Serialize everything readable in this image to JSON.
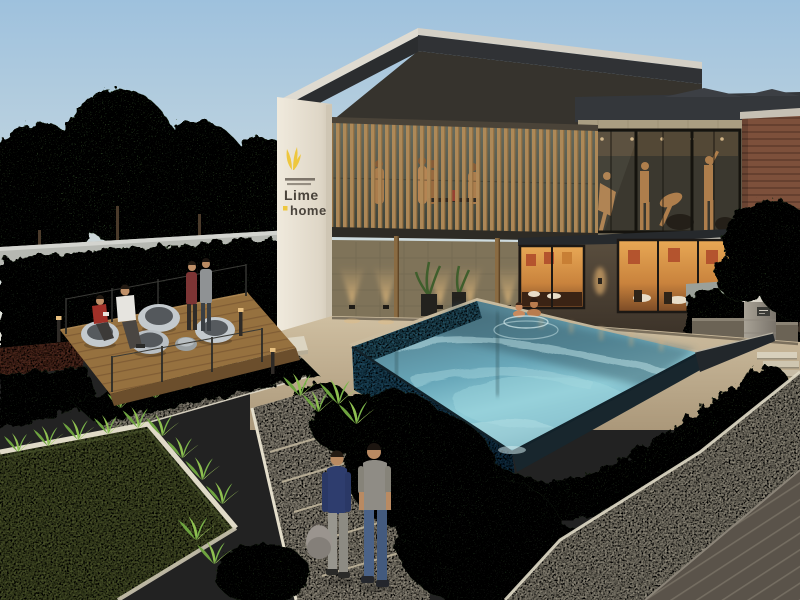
{
  "scene": {
    "title": "Residential clubhouse with infinity pool at dusk — architectural rendering",
    "signage": {
      "line1": "Lime",
      "line2": "home",
      "tagline_rows": 2
    },
    "people": {
      "lounge_deck_people": 4,
      "pool_swimmers": 2,
      "gym_silhouettes": 4,
      "foreground_walkers": 2
    }
  },
  "palette": {
    "sky_top": "#9ec1dd",
    "sky_horizon": "#e3e3d8",
    "roof_fascia_light": "#dfdbd1",
    "roof_dark": "#2b2d2f",
    "slat_wood": "#b08a58",
    "signage_wall_white": "#ece7db",
    "sign_yellow": "#eec73e",
    "sign_text": "#4a443c",
    "gym_frame_tan": "#aa9e82",
    "brick": "#7d503b",
    "interior_glow": "#e8a855",
    "uplight_glow": "#e7bd7e",
    "water_bright": "#8ecbd6",
    "water_deep": "#517d8c",
    "mosaic_tile": "#2f6e8a",
    "hedge_dark": "#2a4222",
    "spiky_plant": "#7fb24a",
    "lawn": "#6e7a41",
    "path_stone": "#d6ccb6",
    "deck_wood": "#96713f",
    "board_deck": "#59524a",
    "chair_shell": "#c3c9cd",
    "navy_sweater": "#2e3d6e",
    "gray_tshirt": "#8f8c85",
    "jeans": "#4a6288"
  }
}
